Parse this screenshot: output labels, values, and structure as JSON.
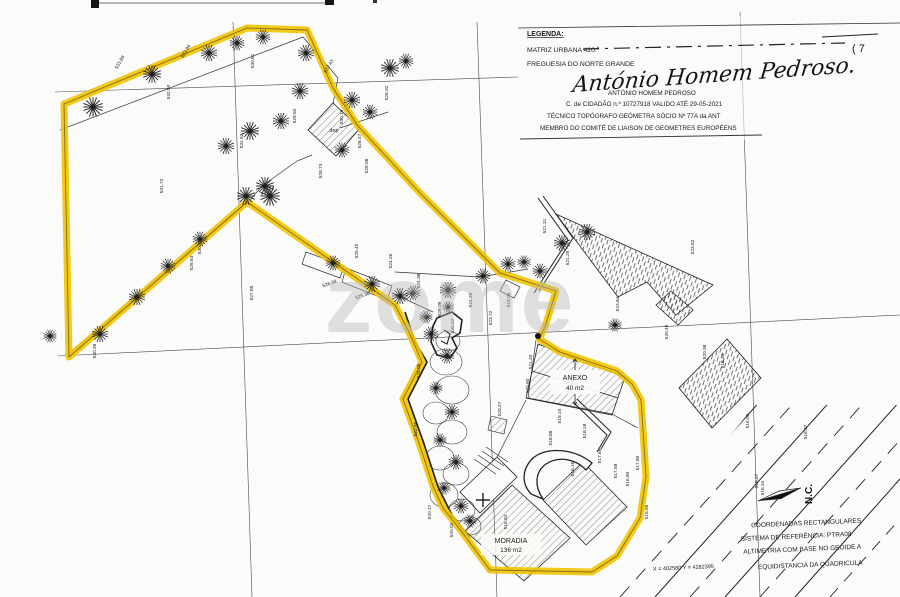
{
  "legend": {
    "title": "LEGENDA:",
    "matriz": "MATRIZ URBANA 420.ª",
    "freguesia": "FREGUESIA DO NORTE GRANDE",
    "boundary_note": "( 7",
    "signature_script": "António Homem Pedroso.",
    "signature_name": "ANTÓNIO  HOMEM  PEDROSO",
    "credential1": "C. de CIDADÃO n.º 10727918 VALIDO ATÉ  29-05-2021",
    "credential2": "TÉCNICO TOPÓGRAFO GEÓMETRA      SÓCIO Nº 77A da ANT",
    "credential3": "MEMBRO DO COMITÉ DE LIAISON     DE GEOMETRES EUROPÉENS"
  },
  "map": {
    "watermark": "zome",
    "north_label": "N.C.",
    "labels": {
      "dep": "dep",
      "anexo": "ANEXO",
      "anexo_area": "40 m2",
      "moradia": "MORADIA",
      "moradia_area": "136 m2"
    },
    "colors": {
      "boundary_highlight": "#f2c300",
      "ink": "#2b2b2b",
      "watermark": "#b5b5b5"
    },
    "spot_elevations": [
      [
        170,
        92,
        "532.90"
      ],
      [
        243,
        141,
        "531.52"
      ],
      [
        163,
        186,
        "531.72"
      ],
      [
        121,
        63,
        "533.69",
        -60
      ],
      [
        187,
        52,
        "533.84",
        -60
      ],
      [
        254,
        61,
        "530.61"
      ],
      [
        96,
        351,
        "530.39"
      ],
      [
        253,
        293,
        "527.89"
      ],
      [
        193,
        263,
        "529.64"
      ],
      [
        201,
        247,
        "530.72"
      ],
      [
        296,
        116,
        "529.50"
      ],
      [
        322,
        171,
        "528.73"
      ],
      [
        343,
        117,
        "530.19"
      ],
      [
        361,
        141,
        "528.47"
      ],
      [
        368,
        166,
        "529.08"
      ],
      [
        388,
        93,
        "528.02"
      ],
      [
        330,
        67,
        "532.43",
        -60
      ],
      [
        358,
        251,
        "525.45"
      ],
      [
        330,
        285,
        "526.38",
        -20
      ],
      [
        363,
        297,
        "525.36",
        -20
      ],
      [
        392,
        261,
        "524.26"
      ],
      [
        420,
        281,
        "524.38"
      ],
      [
        441,
        309,
        "529.09"
      ],
      [
        454,
        326,
        "530.22"
      ],
      [
        472,
        300,
        "524.29"
      ],
      [
        492,
        318,
        "523.72"
      ],
      [
        510,
        300,
        "523.05"
      ],
      [
        694,
        247,
        "523.62"
      ],
      [
        546,
        226,
        "521.31"
      ],
      [
        569,
        258,
        "521.25"
      ],
      [
        619,
        304,
        "523.84"
      ],
      [
        668,
        332,
        "520.48"
      ],
      [
        706,
        352,
        "520.38"
      ],
      [
        724,
        361,
        "518.34"
      ],
      [
        749,
        421,
        "516.03"
      ],
      [
        807,
        432,
        "518.07"
      ],
      [
        758,
        481,
        "518.27"
      ],
      [
        764,
        488,
        "516.34"
      ],
      [
        532,
        362,
        "521.20"
      ],
      [
        529,
        386,
        "520.90"
      ],
      [
        552,
        438,
        "518.88"
      ],
      [
        574,
        469,
        "516.16"
      ],
      [
        601,
        456,
        "517.65"
      ],
      [
        617,
        471,
        "517.58"
      ],
      [
        561,
        416,
        "519.15"
      ],
      [
        586,
        431,
        "518.18"
      ],
      [
        629,
        479,
        "516.80"
      ],
      [
        639,
        463,
        "517.80"
      ],
      [
        420,
        371,
        "524.05"
      ],
      [
        417,
        429,
        "522.55"
      ],
      [
        431,
        512,
        "520.17"
      ],
      [
        453,
        530,
        "520.02"
      ],
      [
        501,
        409,
        "520.27"
      ],
      [
        648,
        512,
        "515.56"
      ],
      [
        507,
        522,
        "516.84"
      ]
    ],
    "trees": [
      [
        93,
        107,
        1.2
      ],
      [
        152,
        74,
        1.1
      ],
      [
        209,
        53,
        1
      ],
      [
        237,
        43,
        0.9
      ],
      [
        263,
        37,
        0.9
      ],
      [
        306,
        53,
        1
      ],
      [
        390,
        68,
        1.1
      ],
      [
        406,
        61,
        0.9
      ],
      [
        352,
        100,
        1
      ],
      [
        370,
        112,
        0.9
      ],
      [
        300,
        91,
        1
      ],
      [
        281,
        121,
        1
      ],
      [
        250,
        131,
        1.1
      ],
      [
        226,
        146,
        1
      ],
      [
        265,
        186,
        1.1
      ],
      [
        342,
        150,
        0.9
      ],
      [
        100,
        334,
        1
      ],
      [
        137,
        297,
        1
      ],
      [
        168,
        266,
        0.9
      ],
      [
        200,
        239,
        0.9
      ],
      [
        246,
        196,
        1.1
      ],
      [
        270,
        196,
        1.2
      ],
      [
        50,
        336,
        0.8
      ],
      [
        333,
        263,
        0.9
      ],
      [
        372,
        284,
        1
      ],
      [
        400,
        296,
        1
      ],
      [
        413,
        293,
        0.9
      ],
      [
        448,
        290,
        1
      ],
      [
        483,
        276,
        0.9
      ],
      [
        508,
        264,
        0.9
      ],
      [
        524,
        262,
        0.8
      ],
      [
        540,
        271,
        0.9
      ],
      [
        562,
        243,
        1
      ],
      [
        587,
        232,
        1
      ],
      [
        431,
        334,
        0.9
      ],
      [
        447,
        356,
        0.9
      ],
      [
        436,
        388,
        0.8
      ],
      [
        452,
        412,
        0.9
      ],
      [
        440,
        440,
        0.8
      ],
      [
        456,
        462,
        0.9
      ],
      [
        444,
        488,
        0.8
      ],
      [
        461,
        506,
        0.9
      ],
      [
        470,
        521,
        0.8
      ],
      [
        426,
        317,
        0.8
      ],
      [
        448,
        307,
        0.7
      ],
      [
        615,
        325,
        0.8
      ]
    ],
    "canopies": [
      [
        446,
        362,
        16,
        13
      ],
      [
        452,
        390,
        17,
        14
      ],
      [
        436,
        413,
        13,
        11
      ],
      [
        452,
        432,
        15,
        12
      ],
      [
        440,
        458,
        14,
        12
      ],
      [
        456,
        474,
        13,
        11
      ],
      [
        444,
        495,
        14,
        12
      ],
      [
        462,
        510,
        13,
        11
      ],
      [
        470,
        526,
        11,
        9
      ],
      [
        448,
        341,
        12,
        10
      ]
    ]
  },
  "footer": {
    "line1": "COORDENADAS RECTANGULARES",
    "line2": "SISTEMA DE REFERÊNCIA: PTRA08",
    "line3": "ALTIMETRIA COM BASE NO GEOIDE A",
    "line4": "EQUIDISTANCIA DA QUADRICULA",
    "coordinates": "X = 402580      Y = 4282395"
  }
}
